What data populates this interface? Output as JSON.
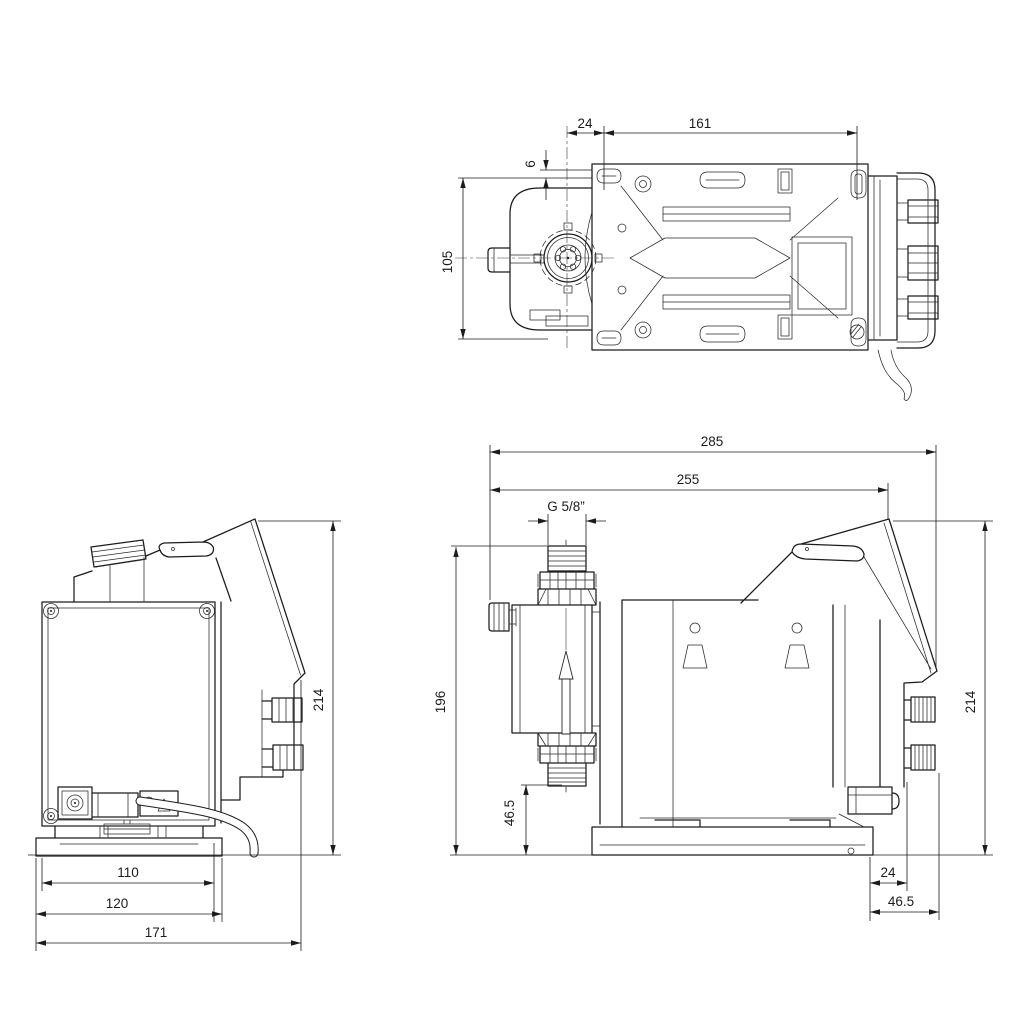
{
  "drawing": {
    "type": "technical-dimension-drawing",
    "subject": "dosing-pump",
    "colors": {
      "background": "#ffffff",
      "line": "#1c1c1c"
    },
    "views": {
      "top": {
        "name": "top view",
        "dims": {
          "d24": "24",
          "d161": "161",
          "d6": "6",
          "d105": "105"
        }
      },
      "side": {
        "name": "side view",
        "dims": {
          "d285": "285",
          "d255": "255",
          "thread": "G 5/8”",
          "d196": "196",
          "d46_5_suction": "46.5",
          "d214": "214",
          "d24": "24",
          "d46_5_knob": "46.5"
        }
      },
      "front": {
        "name": "front view",
        "dims": {
          "d214": "214",
          "d110": "110",
          "d120": "120",
          "d171": "171"
        }
      }
    }
  }
}
